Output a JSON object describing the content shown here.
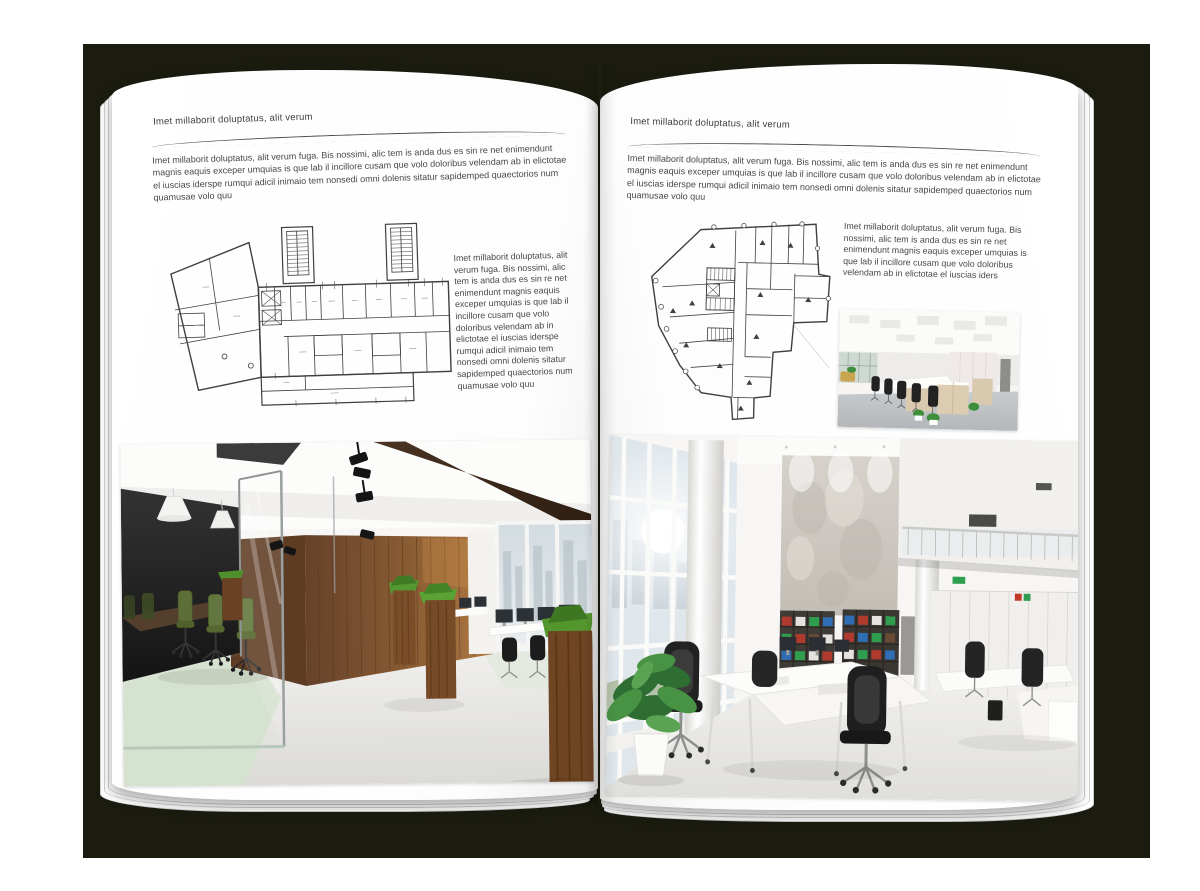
{
  "scene": {
    "description": "Open A4 brochure spread mockup on dark backdrop",
    "colors": {
      "backdrop": "#1b1c0f",
      "page": "#ffffff",
      "text": "#474747",
      "rule": "#4a4a4a",
      "wood_wall": "#7a5433",
      "planter_grass": "#4f8f2c",
      "conference_chair_green": "#4a6327",
      "binder_red": "#b03a2e",
      "binder_blue": "#2f6db5",
      "binder_green": "#2f9e4f"
    }
  },
  "left_page": {
    "header": "Imet millaborit doluptatus, alit verum",
    "intro": "Imet millaborit doluptatus, alit verum fuga. Bis nossimi, alic tem is anda dus es sin re net enimendunt magnis eaquis exceper umquias is que lab il incillore cusam que volo doloribus velendam ab in elictotae el iuscias iderspe rumqui adicil inimaio tem nonsedi omni dolenis sitatur sapidemped quaectorios num quamusae volo quu",
    "side_text": "Imet millaborit doluptatus, alit verum fuga. Bis nossimi, alic tem is anda dus es sin re net enimendunt magnis eaquis exceper umquias is que lab il incillore cusam que volo doloribus velendam ab in elictotae el iuscias iderspe rumqui adicil inimaio tem nonsedi omni dolenis sitatur sapidemped quaectorios num quamusae volo quu",
    "plan_description": "Black-line architectural floor plan of an elongated building with two stair towers and an angled left wing",
    "photo_description": "Office interior photo: glass-walled conference room with green chairs, dark wood wall, wooden grass planters, white desks with monitors and concrete floor"
  },
  "right_page": {
    "header": "Imet millaborit doluptatus, alit verum",
    "intro": "Imet millaborit doluptatus, alit verum fuga. Bis nossimi, alic tem is anda dus es sin re net enimendunt magnis eaquis exceper umquias is que lab il incillore cusam que volo doloribus velendam ab in elictotae el iuscias iderspe rumqui adicil inimaio tem nonsedi omni dolenis sitatur sapidemped quaectorios num quamusae volo quu",
    "side_text": "Imet millaborit doluptatus, alit verum fuga. Bis nossimi, alic tem is anda dus es sin re net enimendunt magnis eaquis exceper umquias is que lab il incillore cusam que volo doloribus velendam ab in elictotae el iuscias iders",
    "plan_description": "Black-line architectural floor plan of an irregular corner building with column markers",
    "small_photo_description": "Small photo: bright open-plan office with rows of desks, light wood cabinets, black chairs and plants",
    "photo_description": "Large photo: double-height white office with glazed window wall, concrete feature wall, shelving with colorful binders, white desks and black mesh chairs"
  }
}
